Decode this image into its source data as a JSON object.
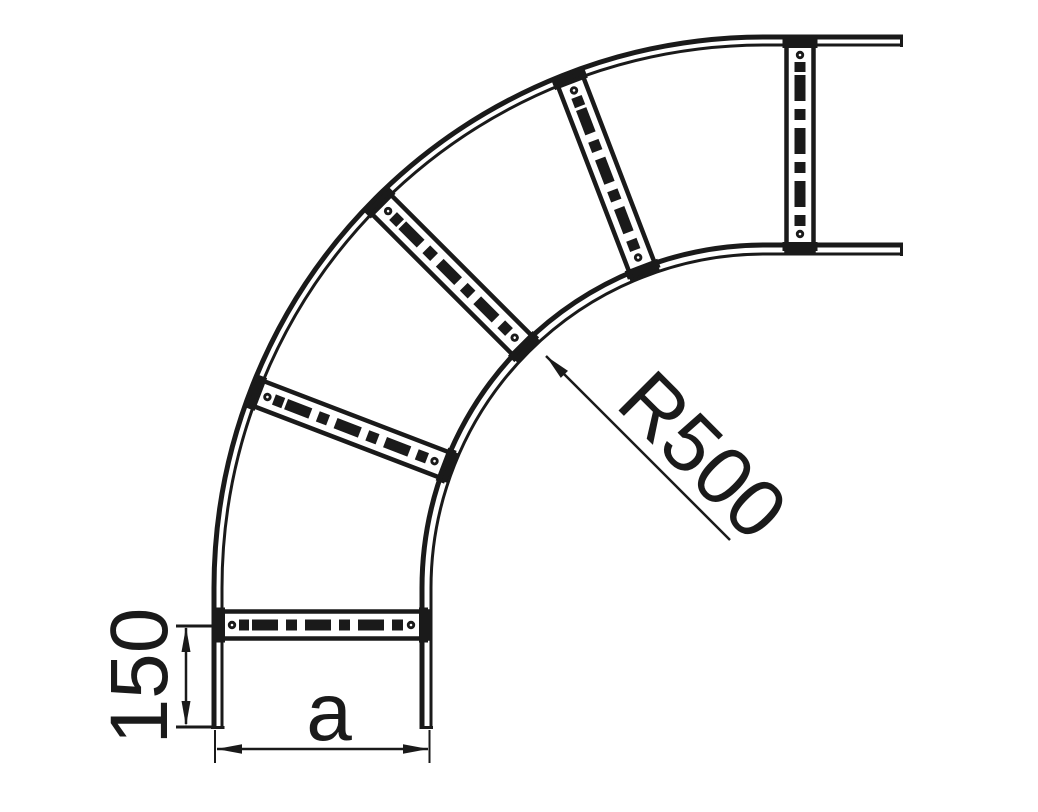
{
  "drawing": {
    "type": "technical-drawing",
    "subject": "cable-ladder-90-degree-bend",
    "background_color": "#ffffff",
    "ink_color": "#1a1a1a",
    "dimensions": {
      "radius": {
        "label": "R500"
      },
      "rung_offset": {
        "label": "150"
      },
      "width": {
        "label": "a"
      }
    }
  }
}
